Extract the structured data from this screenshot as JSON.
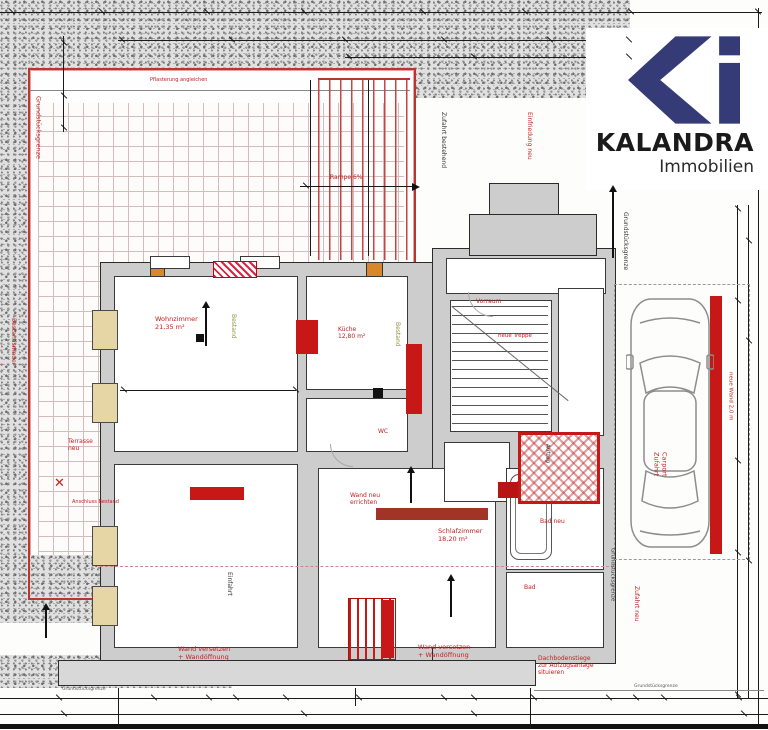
{
  "logo": {
    "brand": "KALANDRA",
    "subtitle": "Immobilien",
    "mark": "ki-monogram",
    "brand_color": "#343b76"
  },
  "plan_type": "Grundriss (floor plan with red revision markings)",
  "colors": {
    "revision_red": "#c81717",
    "wall_gray": "#cdcdcd",
    "stipple_gray": "#9a9a9a",
    "tile_line": "#d2bcbc",
    "window_tan": "#e6d6a6",
    "existing_olive": "#8f8f3f",
    "terrace_border_red": "#b83530"
  },
  "annotations": [
    {
      "name": "grenze-left",
      "text": "Grundstücksgrenze",
      "x": 34,
      "y": 96,
      "size": 6.5,
      "color": "#c22020",
      "rot": 90
    },
    {
      "name": "bestandsmauer",
      "text": "Bestandsmauer",
      "x": 10,
      "y": 318,
      "size": 6,
      "color": "#c22020",
      "rot": 90
    },
    {
      "name": "terrasse-neu",
      "text": "Terrasse\nneu",
      "x": 68,
      "y": 438,
      "size": 6,
      "color": "#c22020"
    },
    {
      "name": "anschluss",
      "text": "Anschluss Bestand",
      "x": 72,
      "y": 500,
      "size": 5,
      "color": "#c22020"
    },
    {
      "name": "x-mark",
      "text": "✕",
      "x": 54,
      "y": 476,
      "size": 13,
      "color": "#c22020"
    },
    {
      "name": "pflaster",
      "text": "Pflasterung angleichen",
      "x": 150,
      "y": 78,
      "size": 5,
      "color": "#c22020"
    },
    {
      "name": "rampe",
      "text": "Rampe 6%",
      "x": 330,
      "y": 174,
      "size": 6,
      "color": "#c22020"
    },
    {
      "name": "zufahrt-bestehend",
      "text": "Zufahrt bestehend",
      "x": 440,
      "y": 112,
      "size": 6,
      "color": "#333333",
      "rot": 90
    },
    {
      "name": "einfriedung-neu",
      "text": "Einfriedung neu",
      "x": 526,
      "y": 112,
      "size": 6,
      "color": "#c22020",
      "rot": 90
    },
    {
      "name": "grenze-right",
      "text": "Grundstücksgrenze",
      "x": 622,
      "y": 212,
      "size": 6,
      "color": "#333333",
      "rot": 90
    },
    {
      "name": "wohnzimmer",
      "text": "Wohnzimmer\n21,35 m²",
      "x": 155,
      "y": 316,
      "size": 6.5,
      "color": "#c22020"
    },
    {
      "name": "bestand-1",
      "text": "Bestand",
      "x": 230,
      "y": 314,
      "size": 6,
      "color": "#8f8f3f",
      "rot": 90
    },
    {
      "name": "kueche",
      "text": "Küche\n12,80 m²",
      "x": 338,
      "y": 326,
      "size": 6,
      "color": "#c22020"
    },
    {
      "name": "bestand-2",
      "text": "Bestand",
      "x": 394,
      "y": 322,
      "size": 6,
      "color": "#8f8f3f",
      "rot": 90
    },
    {
      "name": "vorraum",
      "text": "Vorraum",
      "x": 476,
      "y": 298,
      "size": 6,
      "color": "#c22020"
    },
    {
      "name": "neue-treppe",
      "text": "neue Treppe",
      "x": 498,
      "y": 333,
      "size": 5.5,
      "color": "#c22020"
    },
    {
      "name": "wc",
      "text": "WC",
      "x": 378,
      "y": 428,
      "size": 6,
      "color": "#c22020"
    },
    {
      "name": "aufzug",
      "text": "Aufzug",
      "x": 544,
      "y": 444,
      "size": 5.5,
      "color": "#222222",
      "rot": 90
    },
    {
      "name": "schlafzimmer",
      "text": "Schlafzimmer\n18,20 m²",
      "x": 438,
      "y": 528,
      "size": 6.5,
      "color": "#c22020"
    },
    {
      "name": "bad-neu",
      "text": "Bad neu",
      "x": 540,
      "y": 518,
      "size": 6,
      "color": "#c22020"
    },
    {
      "name": "bad",
      "text": "Bad",
      "x": 524,
      "y": 584,
      "size": 6,
      "color": "#c22020"
    },
    {
      "name": "wand-neu",
      "text": "Wand neu\nerrichten",
      "x": 350,
      "y": 492,
      "size": 6,
      "color": "#c22020"
    },
    {
      "name": "einfahrt",
      "text": "Einfahrt",
      "x": 226,
      "y": 572,
      "size": 6,
      "color": "#333333",
      "rot": 90
    },
    {
      "name": "carport",
      "text": "Carport\nZufahrt",
      "x": 652,
      "y": 452,
      "size": 6.5,
      "color": "#c22020",
      "rot": 90
    },
    {
      "name": "neue-wand",
      "text": "neue Wand 2,0 m",
      "x": 727,
      "y": 372,
      "size": 5.5,
      "color": "#c22020",
      "rot": 90
    },
    {
      "name": "zufahrt-neu",
      "text": "Zufahrt neu",
      "x": 633,
      "y": 586,
      "size": 6,
      "color": "#c22020",
      "rot": 90
    },
    {
      "name": "grenze-bottom",
      "text": "Grundstücksgrenze",
      "x": 609,
      "y": 548,
      "size": 5.5,
      "color": "#333333",
      "rot": 90
    },
    {
      "name": "note-links",
      "text": "Wand versetzen\n+ Wandöffnung",
      "x": 178,
      "y": 646,
      "size": 6.5,
      "color": "#c22020"
    },
    {
      "name": "note-mitte",
      "text": "Wand versetzen\n+ Wandöffnung",
      "x": 418,
      "y": 644,
      "size": 6.5,
      "color": "#c22020"
    },
    {
      "name": "note-rechts",
      "text": "Dachbodenstiege\nzur Aufzugsanlage\nsituieren",
      "x": 538,
      "y": 655,
      "size": 6,
      "color": "#c22020"
    },
    {
      "name": "grenze-lbl-bl",
      "text": "Grundstücksgrenze",
      "x": 62,
      "y": 687,
      "size": 4.5,
      "color": "#555555"
    },
    {
      "name": "grenze-lbl-br",
      "text": "Grundstücksgrenze",
      "x": 634,
      "y": 684,
      "size": 4.5,
      "color": "#555555"
    }
  ],
  "ticks": [
    {
      "x": 8,
      "y": 11
    },
    {
      "x": 98,
      "y": 11
    },
    {
      "x": 203,
      "y": 11
    },
    {
      "x": 300,
      "y": 11
    },
    {
      "x": 419,
      "y": 11
    },
    {
      "x": 521,
      "y": 11
    },
    {
      "x": 627,
      "y": 11
    },
    {
      "x": 754,
      "y": 11
    },
    {
      "x": 118,
      "y": 39
    },
    {
      "x": 228,
      "y": 39
    },
    {
      "x": 341,
      "y": 39
    },
    {
      "x": 440,
      "y": 39
    },
    {
      "x": 546,
      "y": 39
    },
    {
      "x": 625,
      "y": 39
    },
    {
      "x": 345,
      "y": 56
    },
    {
      "x": 470,
      "y": 56
    },
    {
      "x": 625,
      "y": 56
    },
    {
      "x": 60,
      "y": 42
    },
    {
      "x": 60,
      "y": 95
    },
    {
      "x": 60,
      "y": 127
    },
    {
      "x": 120,
      "y": 389
    },
    {
      "x": 292,
      "y": 389
    },
    {
      "x": 302,
      "y": 185
    },
    {
      "x": 734,
      "y": 208
    },
    {
      "x": 734,
      "y": 300
    },
    {
      "x": 734,
      "y": 460
    },
    {
      "x": 734,
      "y": 552
    },
    {
      "x": 734,
      "y": 694
    },
    {
      "x": 745,
      "y": 240
    },
    {
      "x": 745,
      "y": 340
    },
    {
      "x": 745,
      "y": 560
    },
    {
      "x": 55,
      "y": 697
    },
    {
      "x": 150,
      "y": 697
    },
    {
      "x": 205,
      "y": 697
    },
    {
      "x": 232,
      "y": 697
    },
    {
      "x": 282,
      "y": 697
    },
    {
      "x": 355,
      "y": 697
    },
    {
      "x": 440,
      "y": 697
    },
    {
      "x": 470,
      "y": 697
    },
    {
      "x": 530,
      "y": 697
    },
    {
      "x": 605,
      "y": 697
    },
    {
      "x": 632,
      "y": 697
    },
    {
      "x": 660,
      "y": 697
    },
    {
      "x": 735,
      "y": 697
    },
    {
      "x": 60,
      "y": 713
    },
    {
      "x": 300,
      "y": 713
    },
    {
      "x": 470,
      "y": 713
    },
    {
      "x": 740,
      "y": 713
    }
  ],
  "arrows": [
    {
      "x": 612,
      "y": 192,
      "h": 66
    },
    {
      "x": 205,
      "y": 308,
      "h": 38
    },
    {
      "x": 410,
      "y": 473,
      "h": 30
    },
    {
      "x": 450,
      "y": 581,
      "h": 36
    },
    {
      "x": 45,
      "y": 610,
      "h": 28
    }
  ]
}
